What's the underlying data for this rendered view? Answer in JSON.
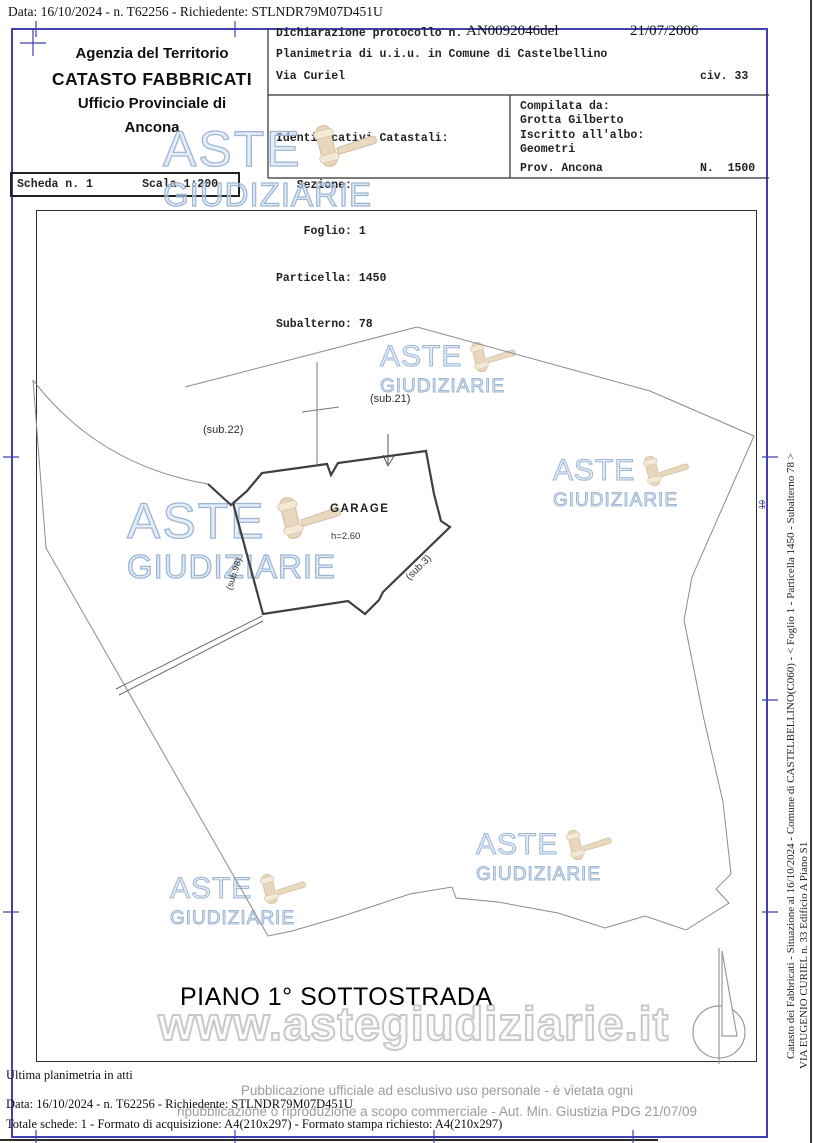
{
  "header": {
    "scan_line": "Data: 16/10/2024 - n. T62256 - Richiedente: STLNDR79M07D451U",
    "agency": {
      "l1": "Agenzia del Territorio",
      "l2": "CATASTO FABBRICATI",
      "l3": "Ufficio Provinciale di",
      "l4": "Ancona"
    },
    "declaration": {
      "label": "Dichiarazione protocollo n.",
      "protocol": "AN0092046del",
      "date": "21/07/2006",
      "subject": "Planimetria di u.i.u. in Comune di Castelbellino",
      "street": "Via Curiel",
      "civic": "civ. 33"
    },
    "catastal": {
      "title": "Identificativi Catastali:",
      "r1": "   Sezione:",
      "r2": "    Foglio: 1",
      "r3": "Particella: 1450",
      "r4": "Subalterno: 78"
    },
    "compiler": {
      "l1": "Compilata da:",
      "l2": "Grotta Gilberto",
      "l3": "Iscritto all'albo:",
      "l4": "Geometri",
      "l5": "Prov. Ancona",
      "l6": "N.  1500"
    },
    "scheda": {
      "left": "Scheda n. 1",
      "right": "Scala 1:200"
    }
  },
  "plan": {
    "sub21": "(sub.21)",
    "sub22": "(sub.22)",
    "sub98": "(sub.98)",
    "sub3": "(sub.3)",
    "room": "GARAGE",
    "room_height": "h=2.60",
    "floor_title": "PIANO 1° SOTTOSTRADA"
  },
  "watermark": {
    "word1": "ASTE",
    "word2": "GIUDIZIARIE",
    "url": "www.astegiudiziarie.it"
  },
  "margin": {
    "side1": "Catasto dei Fabbricati - Situazione al 16/10/2024 - Comune di CASTELBELLINO(C060) - <  Foglio 1 - Particella  1450 - Subalterno 78 >",
    "side2": "VIA EUGENIO CURIEL n. 33  Edificio A Piano S1",
    "stamp": "10"
  },
  "footer": {
    "l1": "Ultima planimetria in atti",
    "l2": "Data: 16/10/2024 - n. T62256 - Richiedente: STLNDR79M07D451U",
    "l3": "Totale schede: 1 - Formato di acquisizione: A4(210x297) - Formato stampa richiesto: A4(210x297)",
    "d1": "Pubblicazione ufficiale ad esclusivo uso personale - è vietata ogni",
    "d2": "ripubblicazione o riproduzione a scopo commerciale - Aut. Min. Giustizia PDG 21/07/09"
  },
  "colors": {
    "frame": "#4040ae",
    "ink": "#1c1c1c",
    "watermark": "#a9bfd9",
    "gavel": "#e8d9c1",
    "outline": "#cfcfcf",
    "gray_text": "#9c9c9c"
  }
}
